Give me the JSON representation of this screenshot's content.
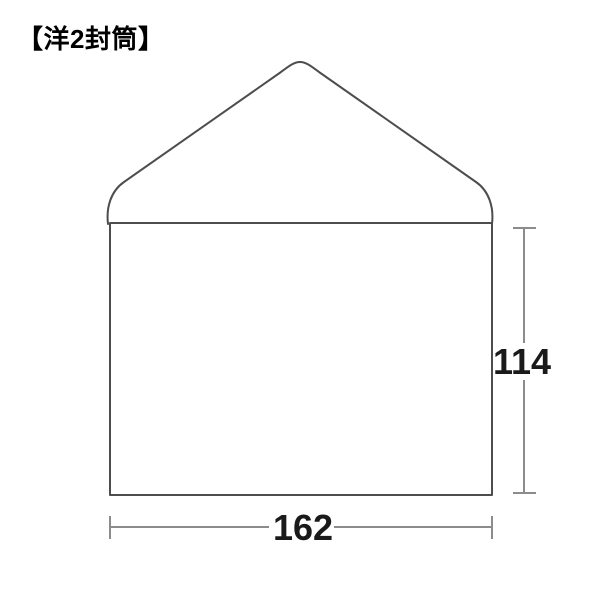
{
  "header": {
    "title": "【洋2封筒】"
  },
  "diagram": {
    "height_label": "114",
    "width_label": "162"
  },
  "colors": {
    "outline": "#4d4d4d",
    "dimension_line": "#8c8c8c",
    "label_text": "#1a1a1a",
    "title_text": "#000000",
    "background": "#ffffff"
  }
}
